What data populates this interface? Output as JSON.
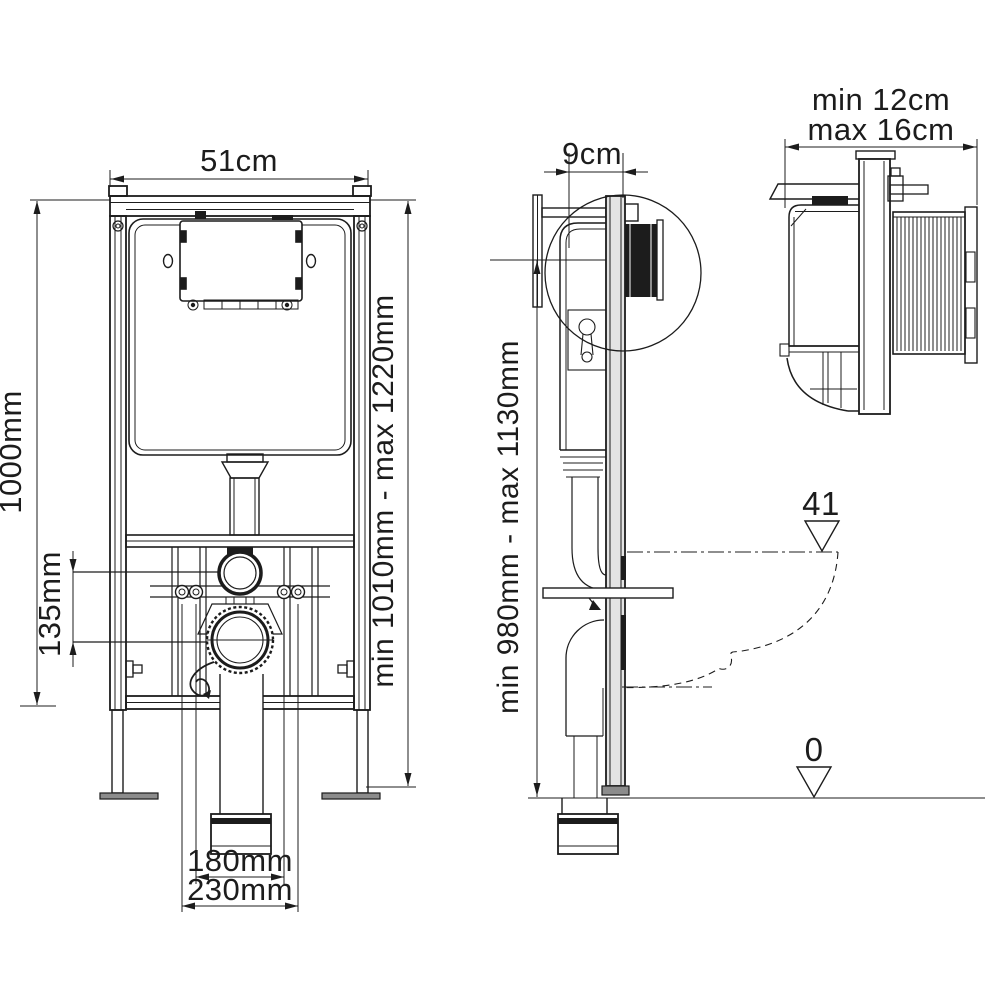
{
  "page": {
    "title": "concealed-cistern-frame-technical-drawing",
    "line_color": "#1c1c1c",
    "background": "#ffffff",
    "metal_fill": "#8c8c8c",
    "rail_fill": "#e4e4e4"
  },
  "front_view": {
    "width": "51cm",
    "height": "1000mm",
    "outlet_offset": "135mm",
    "adjustable_height": "min 1010mm - max 1220mm",
    "fixing_centers_inner": "180mm",
    "fixing_centers_outer": "230mm"
  },
  "side_view": {
    "depth": "9cm",
    "adjustable_height": "min 980mm - max 1130mm",
    "bowl_level": "41",
    "floor_level": "0"
  },
  "plan_view": {
    "wall_distance_min": "min 12cm",
    "wall_distance_max": "max 16cm"
  }
}
